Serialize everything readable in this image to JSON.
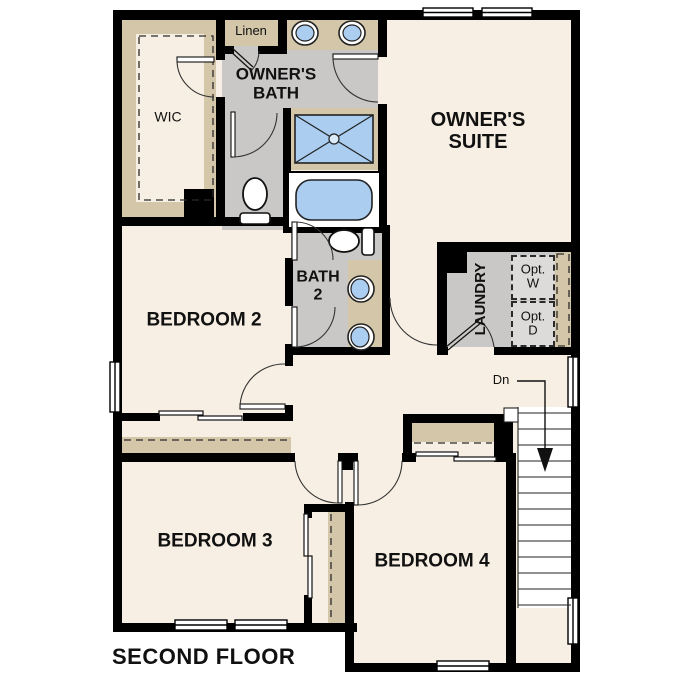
{
  "title": "SECOND FLOOR",
  "rooms": {
    "wic": {
      "label": "WIC"
    },
    "linen": {
      "label": "Linen"
    },
    "owners_bath": {
      "line1": "OWNER'S",
      "line2": "BATH"
    },
    "owners_suite": {
      "line1": "OWNER'S",
      "line2": "SUITE"
    },
    "bedroom2": {
      "label": "BEDROOM 2"
    },
    "bath2": {
      "line1": "BATH",
      "line2": "2"
    },
    "laundry": {
      "label": "LAUNDRY"
    },
    "opt_washer": {
      "line1": "Opt.",
      "line2": "W"
    },
    "opt_dryer": {
      "line1": "Opt.",
      "line2": "D"
    },
    "bedroom3": {
      "label": "BEDROOM 3"
    },
    "bedroom4": {
      "label": "BEDROOM 4"
    }
  },
  "stairs": {
    "direction_label": "Dn"
  },
  "colors": {
    "wall": "#000000",
    "room_floor": "#f7efe3",
    "bath_floor": "#c9c8c6",
    "counter_tan": "#d4c7a9",
    "fixture_blue": "#aacdf0",
    "opt_box_gray": "#dcdbd9",
    "stair_white": "#ffffff"
  },
  "fixtures": [
    "vanity-sink",
    "shower",
    "bathtub",
    "toilet",
    "window",
    "door-arc",
    "bypass-closet-door",
    "stairs-down-arrow"
  ]
}
